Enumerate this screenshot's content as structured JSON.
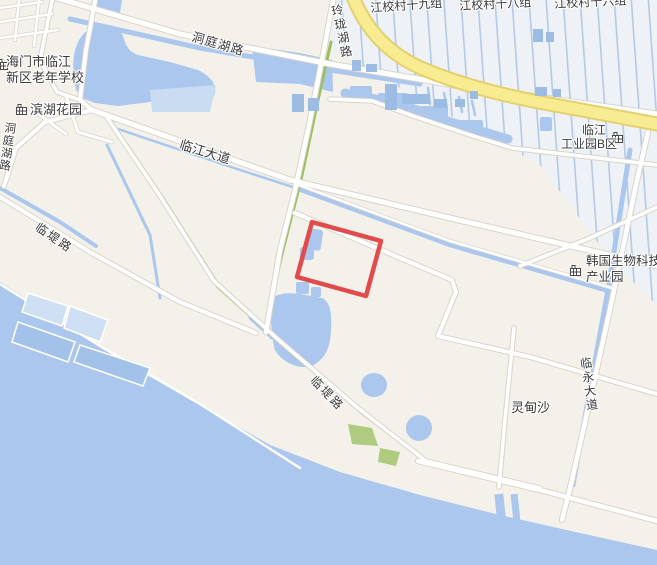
{
  "map": {
    "kind": "street-map-with-highlight",
    "labels": {
      "village19": "江校村十九组",
      "village18": "江校村十八组",
      "village16": "江校村十六组",
      "linglonghu_road": "玲珑湖路",
      "dongtinghu_road_top": "洞庭湖路",
      "dongtinghu_road_left": "洞庭湖路",
      "school_line1": "海门市临江",
      "school_line2": "新区老年学校",
      "binhu_garden": "滨湖花园",
      "linjiang_avenue": "临江大道",
      "lindi_road_west": "临堤路",
      "lindi_road_south": "临堤路",
      "industrial_line1": "临江",
      "industrial_line2": "工业园B区",
      "korea_park_line1": "韩国生物科技",
      "korea_park_line2": "产业园",
      "linyong_avenue": "临永大道",
      "lingdiansha": "灵甸沙"
    },
    "highlight": {
      "shape": "rectangle",
      "color": "#e14b4b"
    },
    "colors": {
      "water": "#abc7ed",
      "land": "#f4f1ea",
      "field": "#eef1f5",
      "field_stripe": "#b3c9e6",
      "highway_fill": "#f8ec92",
      "highway_border": "#e5d06f",
      "road_fill": "#ffffff",
      "road_casing": "#d9d5cb",
      "green_road": "#9cbf62",
      "green_patch": "#aecb7f",
      "building": "#9dbce4",
      "dock": "#cfe0f4",
      "highlight": "#e14b4b",
      "label_text": "#3a3a3a"
    }
  }
}
